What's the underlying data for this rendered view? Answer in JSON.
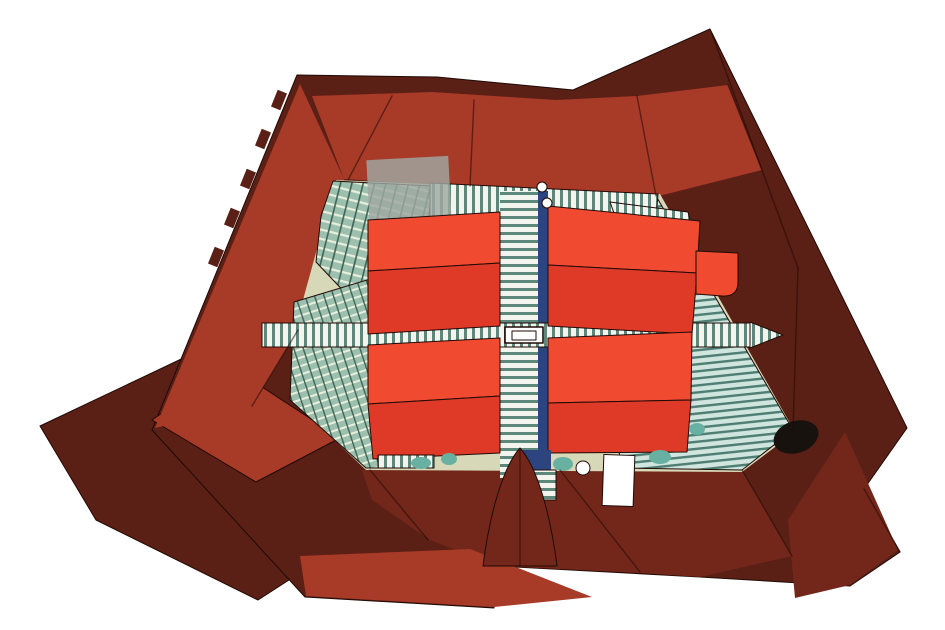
{
  "canvas": {
    "width": 945,
    "height": 630,
    "background_color": "#ffffff"
  },
  "illustration": {
    "kind": "axonometric aerial rendering of a city block",
    "subject": "perimeter building with dark red hipped roofs around an inner courtyard; courtyard holds green glass atrium structures, teal striped glass roofs, and four bright orange pavilion blocks joined by a striped skywalk cross with a central skylight"
  },
  "colors": {
    "background": "#ffffff",
    "maroonDark": "#5a1f15",
    "maroonMid": "#73271a",
    "brickRed": "#a83a28",
    "blockTop": "#f04a31",
    "blockSide": "#de3a27",
    "corridorBlue": "#2c4480",
    "courtyardBeige": "#d7d8b8",
    "canopyGray": "#9fa8a2",
    "treeTeal": "#68b0a1",
    "white": "#ffffff",
    "black": "#17120e",
    "outline": "#200a06",
    "stripeWhite": "#f2f5ee",
    "stripeTeal": "#5d877b",
    "roofBg": "#cfe5de",
    "roofLine": "#4e7d72",
    "glassBg": "#9dbfae",
    "glassLight": "#e9efdd",
    "glassDark": "#3c6557"
  },
  "parts": [
    {
      "name": "annex-wing-roof",
      "color": "maroonDark"
    },
    {
      "name": "perimeter-roof-silhouette",
      "color": "maroonDark"
    },
    {
      "name": "north-roof-slope",
      "color": "brickRed"
    },
    {
      "name": "west-roof-slope",
      "color": "brickRed"
    },
    {
      "name": "south-roof-facets",
      "color": "maroonMid"
    },
    {
      "name": "south-fascia",
      "color": "brickRed"
    },
    {
      "name": "chimney-row",
      "color": "maroonDark"
    },
    {
      "name": "courtyard-floor",
      "color": "courtyardBeige"
    },
    {
      "name": "west-glass-atrium",
      "color": "glassBg"
    },
    {
      "name": "east-glass-roof",
      "color": "roofBg"
    },
    {
      "name": "north-skylight-band",
      "color": "stripeWhite"
    },
    {
      "name": "glass-canopy",
      "color": "canopyGray"
    },
    {
      "name": "skywalk-horizontal",
      "color": "stripeWhite"
    },
    {
      "name": "skywalk-vertical",
      "color": "stripeWhite"
    },
    {
      "name": "skywalk-blue-edge",
      "color": "corridorBlue"
    },
    {
      "name": "pavilion-block-nw",
      "color": "blockTop"
    },
    {
      "name": "pavilion-block-ne",
      "color": "blockTop"
    },
    {
      "name": "pavilion-block-sw",
      "color": "blockTop"
    },
    {
      "name": "pavilion-block-se",
      "color": "blockTop"
    },
    {
      "name": "rounded-corner-tower",
      "color": "blockTop"
    },
    {
      "name": "central-skylight",
      "color": "white"
    },
    {
      "name": "round-skylights",
      "color": "white"
    },
    {
      "name": "white-rooftop-structure",
      "color": "white"
    },
    {
      "name": "courtyard-trees",
      "color": "treeTeal"
    },
    {
      "name": "dark-dome",
      "color": "black"
    },
    {
      "name": "south-gable",
      "color": "maroonMid"
    }
  ]
}
